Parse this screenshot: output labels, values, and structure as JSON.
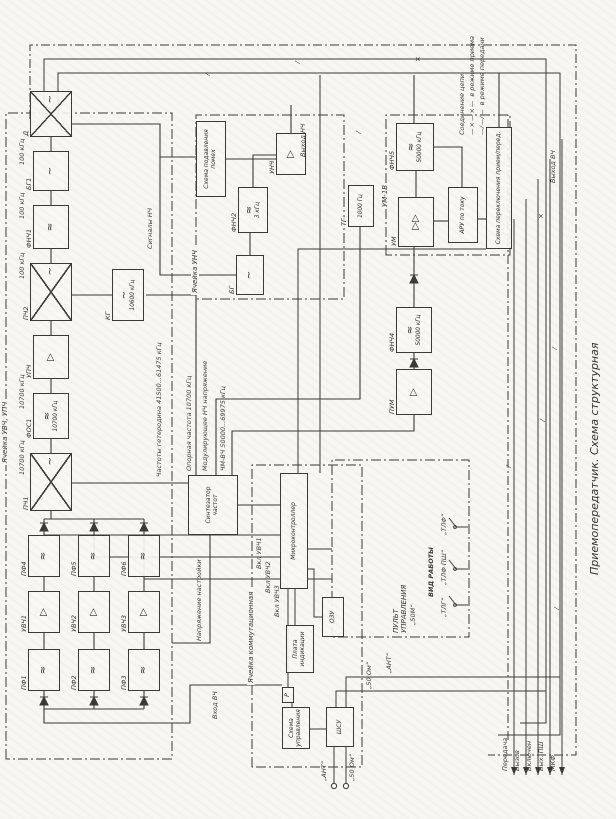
{
  "title": "Приемопередатчик. Схема структурная",
  "cells": {
    "rx": "Ячейка УВЧ, УПЧ",
    "af": "Ячейка УНЧ",
    "pa": "УМ-1В",
    "comm": "Ячейка коммутационная",
    "panel": "ПУЛЬТ УПРАВЛЕНИЯ"
  },
  "blocks": {
    "pf1": "ПФ1",
    "pf2": "ПФ2",
    "pf3": "ПФ3",
    "uvch1": "УВЧ1",
    "uvch2": "УВЧ2",
    "uvch3": "УВЧ3",
    "pf4": "ПФ4",
    "pf5": "ПФ5",
    "pf6": "ПФ6",
    "pch1": "ПЧ1",
    "fos1": "ФОС1",
    "fos1_sub": "10700 кГц",
    "upch": "УПЧ",
    "pch2": "ПЧ2",
    "kg": "КГ",
    "kg_sub": "10600 кГц",
    "fnch1": "ФНЧ1",
    "bg1": "БГ1",
    "d": "Д",
    "noise": "Схема подавления помех",
    "unch": "УНЧ",
    "fnch2": "ФНЧ2",
    "fnch2_sub": "3 кГц",
    "bg": "БГ",
    "tg": "ТГ",
    "tg_sub": "1000 Гц",
    "synth": "Синтезатор частот",
    "pum": "ПУМ",
    "fnch4": "ФНЧ4",
    "fnch4_sub": "50000 кГц",
    "um": "УМ",
    "fnch5": "ФНЧ5",
    "fnch5_sub": "50000 кГц",
    "aru": "АРУ по току",
    "sw": "Схема переключения прием/перед.",
    "mcu": "Микроконтроллер",
    "disp": "Плата индикации",
    "ram": "ОЗУ",
    "ctrl": "Схема управления",
    "r": "Р",
    "shsu": "ШСУ"
  },
  "labels": {
    "f10700a": "10700 кГц",
    "f10700b": "10700 кГц",
    "f100a": "100 кГц",
    "f100b": "100 кГц",
    "f100c": "100 кГц",
    "het": "Частоты гетеродина 41500...61475 кГц",
    "tune": "Напряжение настройки",
    "sig_nch": "Сигналы НЧ",
    "out_nch": "Выход НЧ",
    "ref": "Опорная частота 10700 кГц",
    "mod": "Модулирующее НЧ напряжение",
    "chm": "ЧМ-ВЧ 50000...69975 кГц",
    "in_rf": "Вход ВЧ",
    "out_rf": "Выход ВЧ",
    "on1": "Вкл УВЧ1",
    "on2": "Вкл УВЧ2",
    "on3": "Вкл УВЧ3"
  },
  "terminals": {
    "ant": "„АНТ“",
    "ohm": "„50 Ом“",
    "ant2": "„АНТ“",
    "ohm2": "„50 Ом“"
  },
  "panel": {
    "mode_title": "ВИД РАБОТЫ",
    "opt1": "„ТЛГ“",
    "opt2": "„ТЛФ ПШ“",
    "opt3": "„ТЛФ“",
    "opt4": "„50М“"
  },
  "outputs": {
    "o1": "Передача",
    "o2": "Вызов",
    "o3": "Включен",
    "o4": "Вых. ПШ",
    "o5": "МКФ"
  },
  "legend": {
    "title": "Соединение цепи:",
    "rx_marker": "—×—×—",
    "rx_text": "в режиме приема",
    "tx_marker": "—⁄—⁄—",
    "tx_text": "в режиме передачи"
  },
  "colors": {
    "ink": "#3b3a36",
    "paper": "#f7f6f1"
  }
}
